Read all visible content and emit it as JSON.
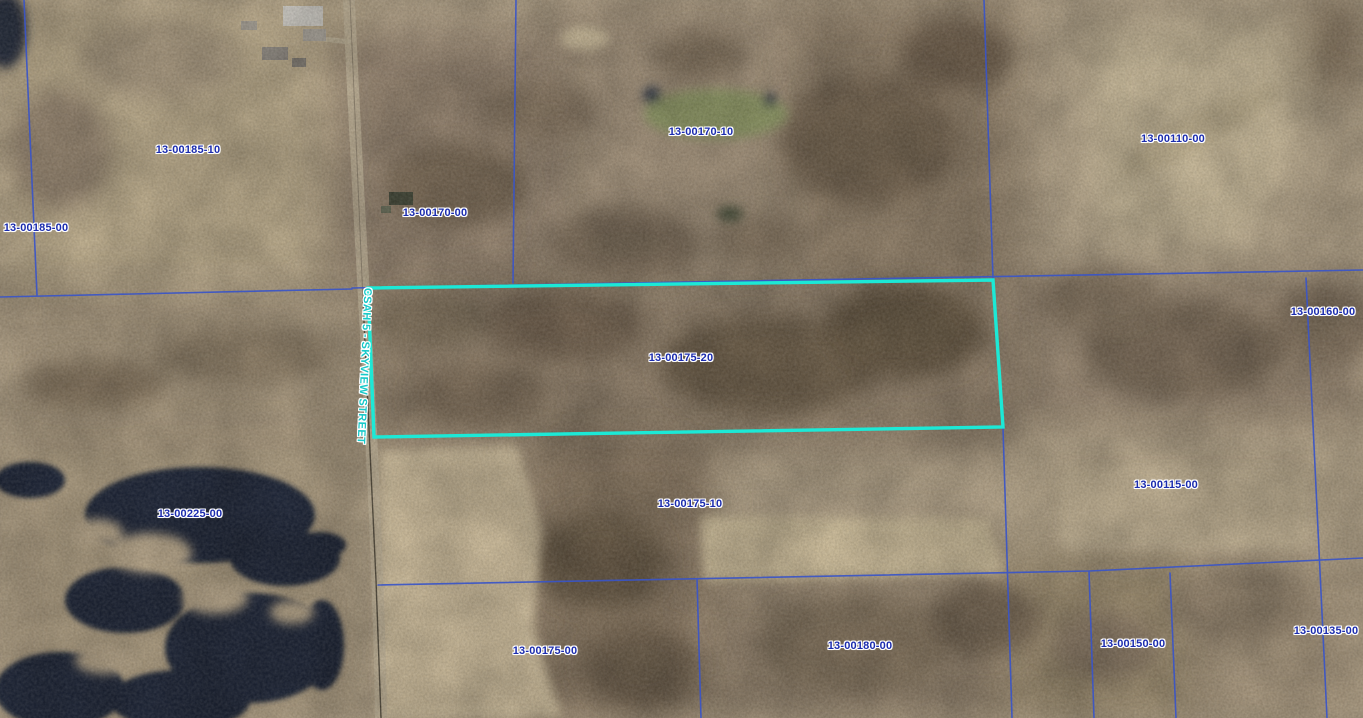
{
  "map": {
    "road_label": "CSAH 5 - SKYVIEW STREET",
    "highlighted_parcel_id": "13-00175-20",
    "colors": {
      "parcel_line": "#3a55c8",
      "highlight": "#1ce9d6",
      "label": "#1b2cae",
      "road_label": "#18c9c9"
    },
    "parcels": [
      {
        "id": "13-00185-10"
      },
      {
        "id": "13-00185-00"
      },
      {
        "id": "13-00170-00"
      },
      {
        "id": "13-00170-10"
      },
      {
        "id": "13-00110-00"
      },
      {
        "id": "13-00160-00"
      },
      {
        "id": "13-00175-20"
      },
      {
        "id": "13-00225-00"
      },
      {
        "id": "13-00175-10"
      },
      {
        "id": "13-00115-00"
      },
      {
        "id": "13-00175-00"
      },
      {
        "id": "13-00180-00"
      },
      {
        "id": "13-00150-00"
      },
      {
        "id": "13-00135-00"
      }
    ]
  }
}
